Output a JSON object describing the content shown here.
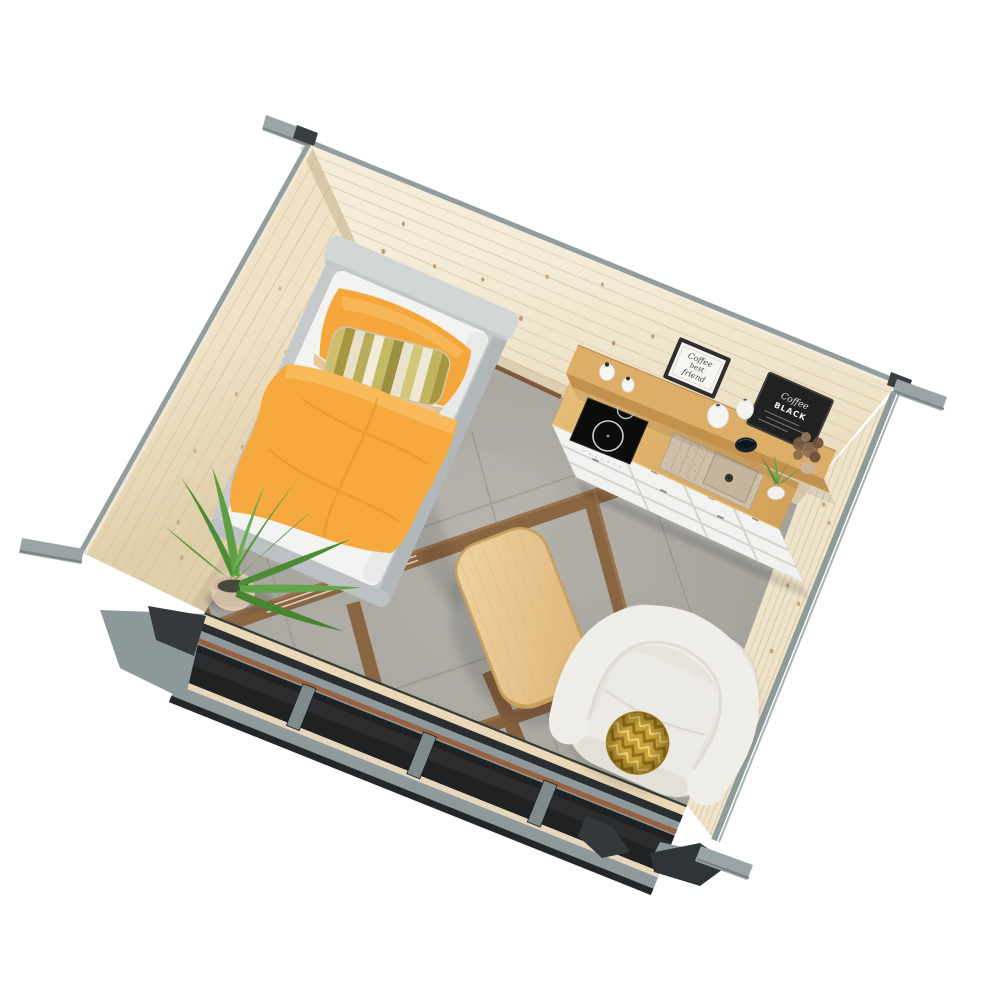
{
  "scene": {
    "title": "Cabin studio interior - aerial cutaway 3D render",
    "view": "top-down isometric cutaway of a small log-cabin studio room",
    "background": "#ffffff"
  },
  "palette": {
    "wall_pine": "#ecdfc2",
    "wall_pine_light": "#f4ecd9",
    "rim_grey": "#939d9d",
    "beam_grey": "#9aa4a4",
    "exterior_grey": "#8c9899",
    "trim_charcoal": "#2b2e30",
    "window_dark": "#1f2123",
    "floor_tile": "#a9a7a0",
    "wood_strip": "#8a6542",
    "bed_frame": "#c6cacc",
    "bedding_white": "#f3f3f2",
    "blanket_orange": "#f6a93e",
    "stripe_olive": "#a59741",
    "table_wood": "#e6c48c",
    "sofa_fabric": "#e6e4dd",
    "pillow_gold": "#c9a137",
    "counter_oak": "#dcae67",
    "cabinet_white": "#f2f2f0",
    "cooktop_black": "#0c0c0e",
    "sink_beige": "#cfc0ab",
    "chalkboard": "#212121",
    "plant_green": "#5a9a40",
    "pot_beige": "#dbc8b3"
  },
  "room": {
    "walls": {
      "back_left": "pine log plank wall",
      "back_right": "pine log plank wall",
      "front_left": "low grey wall with dark glazed windows",
      "front_right": "low pine wall with grey exterior rim",
      "corner_beams": "grey protruding roof beams at each corner"
    },
    "floor": "grey concrete tiles with diagonal wooden inlay strips"
  },
  "furniture": {
    "bed": {
      "name": "single bed",
      "frame": "light grey upholstered frame",
      "bedding": "white sheets",
      "blanket": "orange throw blanket",
      "pillow": "orange pillow",
      "accent_pillow": "olive and cream striped lumbar pillow"
    },
    "kitchenette": {
      "cabinets": "white shaker drawer cabinets",
      "countertop": "oak worktop",
      "hob": "black induction hob with two burners",
      "sink": "beige composite sink with drainboard",
      "shelf": "raised oak bar shelf"
    },
    "coffee_table": {
      "name": "rounded oak coffee table"
    },
    "armchair": {
      "name": "cream boucle loveseat",
      "pillow": "round gold herringbone pillow"
    },
    "plants": [
      {
        "name": "potted palm",
        "pot": "beige pot"
      },
      {
        "name": "dried bouquet",
        "pot": "terracotta pot"
      },
      {
        "name": "small green plant",
        "pot": "white pot"
      }
    ]
  },
  "decor": {
    "framed_sign": {
      "line1": "Coffee",
      "line2": "best",
      "line3": "friend"
    },
    "chalkboard": {
      "line1": "Coffee",
      "line2": "BLACK"
    },
    "vases": "white ceramic vases and jars",
    "bowl": "dark blue bowl"
  }
}
